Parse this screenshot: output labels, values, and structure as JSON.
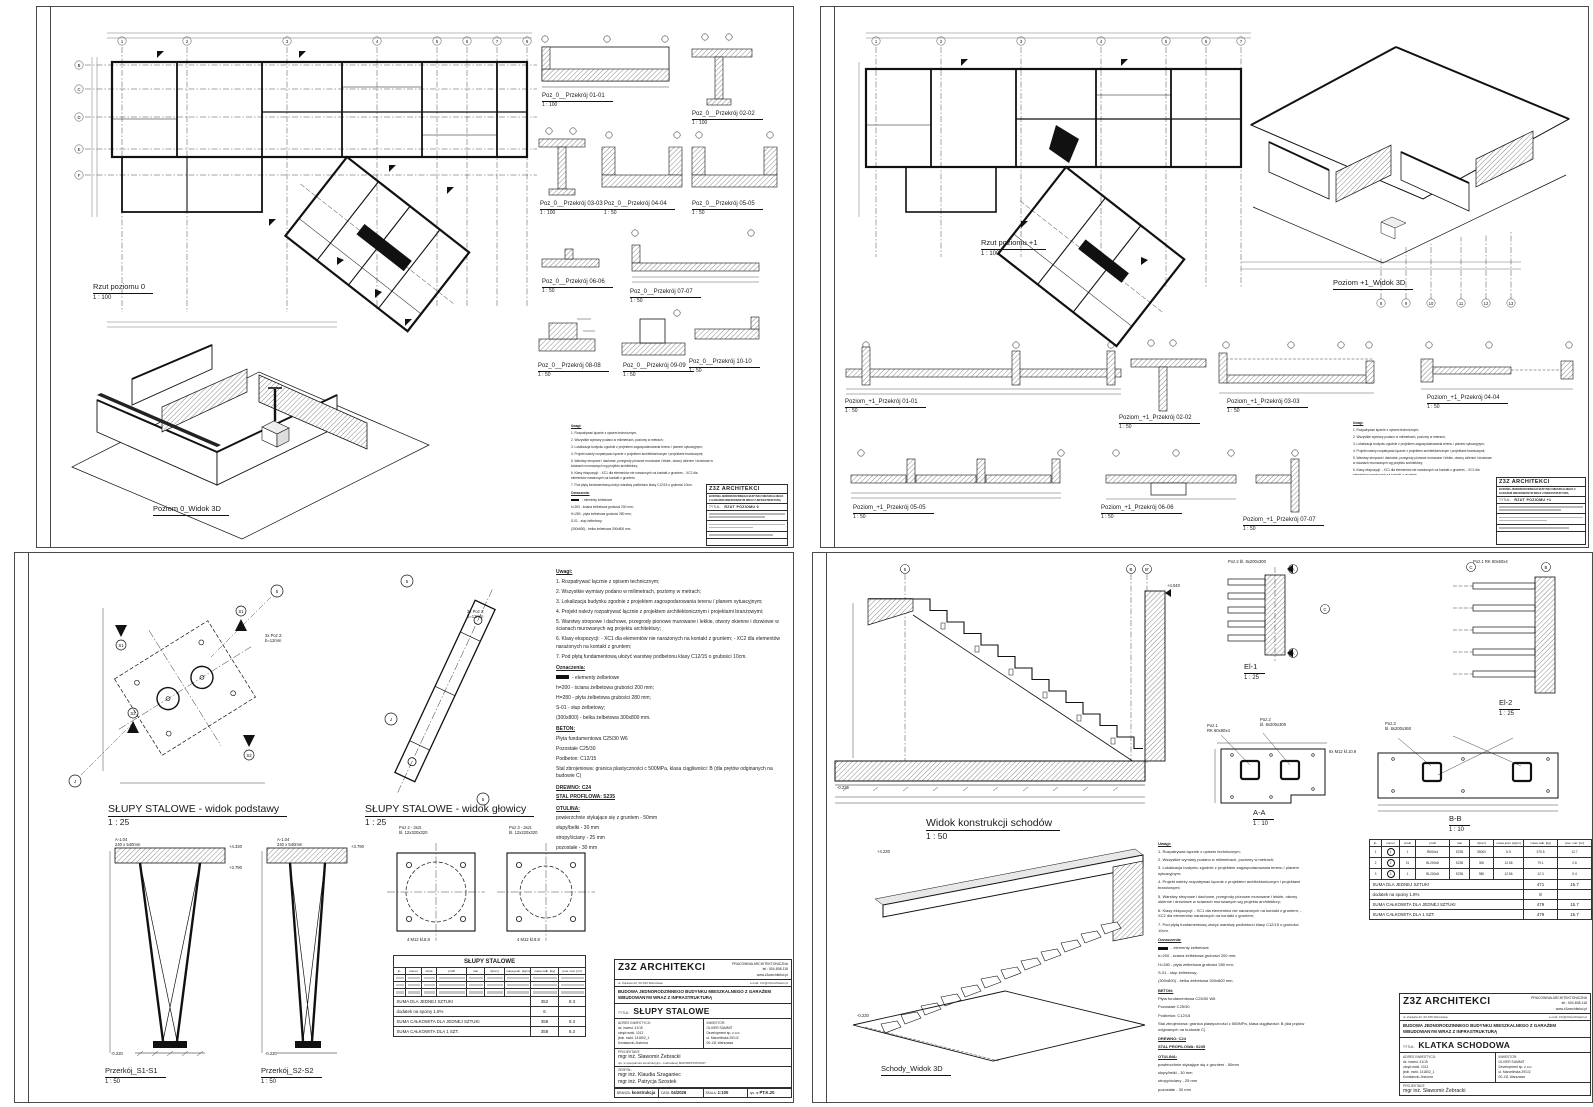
{
  "shared": {
    "notes": {
      "heading": "Uwagi:",
      "items": [
        "1.  Rozpatrywać łącznie z opisem technicznym;",
        "2.  Wszystkie wymiary podano w milimetrach, poziomy w metrach;",
        "3.  Lokalizacja budynku zgodnie z projektem zagospodarowania terenu / planem sytuacyjnym;",
        "4.  Projekt należy rozpatrywać łącznie z projektem architektonicznym i projektami branżowymi;",
        "5.  Warstwy stropowe i dachowe, przegrody pionowe murowane i lekkie, otwory okienne i drzwiowe w ścianach murowanych wg projektu architektury;",
        "6.  Klasy ekspozycji:  - XC1 dla elementów nie narażonych na kontakt z gruntem;  - XC2 dla elementów narażonych na kontakt z gruntem;",
        "7.  Pod płytą fundamentową ułożyć warstwę podbetonu klasy C12/15 o grubości 10cm."
      ]
    },
    "oznaczenia": {
      "heading": "Oznaczenia:",
      "swatch_desc": "- elementy żelbetowe",
      "items": [
        "h=200      - ściana żelbetowa grubości 200 mm;",
        "H=280      - płyta żelbetowa grubości 280 mm;",
        "S-01        - słup żelbetowy;",
        "(300x800) - belka żelbetowa 300x800 mm."
      ]
    },
    "beton": {
      "heading": "BETON:",
      "items": [
        "Płyta fundamentowa C25/30 W6",
        "Pozostałe C25/30",
        "Podbeton:        C12/15",
        "Stal zbrojeniowa:  granica plastyczności c 500MPa, klasa ciągliwości: B (dla prętów odginanych na budowie C)"
      ]
    },
    "drewno": "DREWNO: C24",
    "stal_profilowa": "STAL PROFILOWA:   S235",
    "otulina": {
      "heading": "OTULINA:",
      "items": [
        "powierzchnie stykające się z gruntem   - 50mm",
        "słupy/belki    - 30 mm",
        "stropy/ściany  - 25 mm",
        "pozostałe      - 30 mm"
      ]
    },
    "firm": {
      "name": "Z3Z  ARCHITEKCI",
      "type": "PRACOWNIA ARCHITEKTONICZNA",
      "address": "ul. Żurawia 22, 00-515 Warszawa",
      "email": "e-mail: z3z@z3zarchitekci.pl",
      "tel": "tel.: 504-808-118",
      "www": "www.z3zarchitekci.pl",
      "project": "BUDOWA JEDNORODZINNEGO BUDYNKU MIESZKALNEGO Z GARAŻEM WBUDOWANYM WRAZ Z INFRASTRUKTURĄ",
      "tytul_label": "TYTUŁ:",
      "adres_label": "ADRES INWESTYCJI:",
      "adres_lines": [
        "dz. inwest. 41/15",
        "obręb ewid. 1012",
        "jedn. ewid. 141802_1",
        "Konstancin-Jeziorna"
      ],
      "inwestor_label": "INWESTOR:",
      "inwestor_lines": [
        "OLIVER SUMMIT",
        "Development sp. z o.o.",
        "ul. Marcelińska 29/1/2",
        "00-131 Warszawa"
      ],
      "projektant_label": "PROJEKTANT:",
      "projektant": "mgr inż. Sławomir Żebracki",
      "projektant_upr": "upr. w specjalności konstrukcyjno - budowlanej MAP/0087/PWOK/07",
      "zespol_label": "ZESPÓŁ:",
      "zespol": [
        "mgr inż. Klaudia Szaganiec",
        "mgr inż. Patrycja Szostek"
      ],
      "branza_label": "BRANŻA:",
      "branza": "konstrukcja",
      "data_label": "DATA:",
      "data": "04/2026",
      "skala_label": "SKALA:",
      "skala": "1:100",
      "rysnr_label": "rys. nr"
    },
    "th": [
      "lp.",
      "numer",
      "sztuk",
      "profil",
      "stal",
      "d[mm]",
      "masa jedn. [kg/m]",
      "masa całk. [kg]",
      "pow. mal. [m²]"
    ],
    "sum1": "SUMA DLA JEDNEJ SZTUKI",
    "sum2": "dodatek na spoiny 1.8%",
    "sum3": "SUMA CAŁKOWITA DLA JEDNEJ SZTUKI",
    "sum4": "SUMA CAŁKOWITA DLA 1 SZT."
  },
  "s1": {
    "plan_title": "Rzut poziomu 0",
    "plan_scale": "1 : 100",
    "view3d_title": "Poziom 0_Widok 3D",
    "tytul": "RZUT POZIOMU 0",
    "axes_top": [
      "1",
      "2",
      "3",
      "4",
      "5",
      "6",
      "7",
      "8"
    ],
    "axes_left": [
      "B",
      "C",
      "D",
      "E",
      "F"
    ],
    "sections": [
      {
        "t": "Poz_0__Przekrój 01-01",
        "s": "1 : 100"
      },
      {
        "t": "Poz_0__Przekrój 02-02",
        "s": "1 : 100"
      },
      {
        "t": "Poz_0__Przekrój 03-03",
        "s": "1 : 100"
      },
      {
        "t": "Poz_0__Przekrój 04-04",
        "s": "1 : 50"
      },
      {
        "t": "Poz_0__Przekrój 05-05",
        "s": "1 : 50"
      },
      {
        "t": "Poz_0__Przekrój 06-06",
        "s": "1 : 50"
      },
      {
        "t": "Poz_0__Przekrój 07-07",
        "s": "1 : 50"
      },
      {
        "t": "Poz_0__Przekrój 08-08",
        "s": "1 : 50"
      },
      {
        "t": "Poz_0__Przekrój 09-09",
        "s": "1 : 50"
      },
      {
        "t": "Poz_0__Przekrój 10-10",
        "s": "1 : 50"
      }
    ]
  },
  "s2": {
    "plan_title": "Rzut poziomu +1",
    "plan_scale": "1 : 100",
    "view3d_title": "Poziom +1_Widok 3D",
    "tytul": "RZUT POZIOMU +1",
    "axes_top": [
      "1",
      "2",
      "3",
      "4",
      "5",
      "6",
      "7"
    ],
    "axes_bottom": [
      "8",
      "9",
      "10",
      "11",
      "12",
      "13"
    ],
    "sections": [
      {
        "t": "Poziom_+1_Przekrój 01-01",
        "s": "1 : 50"
      },
      {
        "t": "Poziom_+1_Przekrój 02-02",
        "s": "1 : 50"
      },
      {
        "t": "Poziom_+1_Przekrój 03-03",
        "s": "1 : 50"
      },
      {
        "t": "Poziom_+1_Przekrój 04-04",
        "s": "1 : 50"
      },
      {
        "t": "Poziom_+1_Przekrój 05-05",
        "s": "1 : 50"
      },
      {
        "t": "Poziom_+1_Przekrój 06-06",
        "s": "1 : 50"
      },
      {
        "t": "Poziom_+1_Przekrój 07-07",
        "s": "1 : 50"
      }
    ]
  },
  "s3": {
    "tytul": "SŁUPY STALOWE",
    "rys_nr": "PT.K.20",
    "views": [
      {
        "t": "SŁUPY STALOWE - widok podstawy",
        "s": "1 : 25"
      },
      {
        "t": "SŁUPY STALOWE - widok głowicy",
        "s": "1 : 25"
      },
      {
        "t": "Przerkój_S1-S1",
        "s": "1 : 50"
      },
      {
        "t": "Przerkój_S2-S2",
        "s": "1 : 50"
      }
    ],
    "details": [
      {
        "title": "Poz 2 - 3szt.",
        "plate": "bl. 12x320x320",
        "bolts": "4 M12 kl.8.8"
      },
      {
        "title": "Poz 3 - 3szt.",
        "plate": "bl. 12x220x320",
        "bolts": "4 M12 kl.8.8"
      }
    ],
    "ann": {
      "a104": "A-1.04",
      "size": "240 x 540mm",
      "poz2_3x": "3x Poz 2:",
      "b12": "b=12mm",
      "e1": "+4.330",
      "e2": "+3.790",
      "e3": "-0.220"
    },
    "bub": {
      "five": "5",
      "j": "J",
      "s1": "S1",
      "s2": "S2"
    },
    "table": {
      "title": "SŁUPY STALOWE",
      "sums": [
        {
          "m": "352",
          "a": "8.3"
        },
        {
          "m": "6",
          "a": ""
        },
        {
          "m": "358",
          "a": "8.3"
        },
        {
          "m": "358",
          "a": "8.3"
        }
      ]
    }
  },
  "s4": {
    "tytul": "KLATKA SCHODOWA",
    "rys_nr": "PT.K.30",
    "views": [
      {
        "t": "Widok konstrukcji schodów",
        "s": "1 : 50"
      },
      {
        "t": "El-1",
        "s": "1 : 25"
      },
      {
        "t": "El-2",
        "s": "1 : 25"
      },
      {
        "t": "A-A",
        "s": "1 : 10"
      },
      {
        "t": "B-B",
        "s": "1 : 10"
      },
      {
        "t": "Schody_Widok 3D"
      }
    ],
    "ann": {
      "e4040": "+4.040",
      "e022": "-0.220",
      "e4230": "+4.230",
      "poz1": "Poz.1",
      "poz1v": "RK 60x60x4",
      "poz2": "Poz.2",
      "poz2v": "bl. 8x200x300",
      "poz3": "Poz.3",
      "poz3v": "bl. 8x200x360",
      "m12": "6x M12 kl.10.9"
    },
    "bub": {
      "five": "5",
      "b": "B",
      "bp": "B'",
      "a": "A",
      "c": "C"
    },
    "table": {
      "rows": [
        [
          "1",
          "1",
          "1",
          "RK60x4",
          "S235",
          "55000",
          "6.9",
          "379.5",
          "12.7"
        ],
        [
          "2",
          "2",
          "21",
          "BL200x8",
          "S235",
          "300",
          "12.56",
          "79.1",
          "2.6"
        ],
        [
          "3",
          "3",
          "1",
          "BL200x8",
          "S235",
          "980",
          "12.56",
          "12.3",
          "0.4"
        ]
      ],
      "sums": [
        {
          "m": "471",
          "a": "15.7"
        },
        {
          "m": "8",
          "a": ""
        },
        {
          "m": "479",
          "a": "15.7"
        },
        {
          "m": "479",
          "a": "15.7"
        }
      ]
    }
  }
}
